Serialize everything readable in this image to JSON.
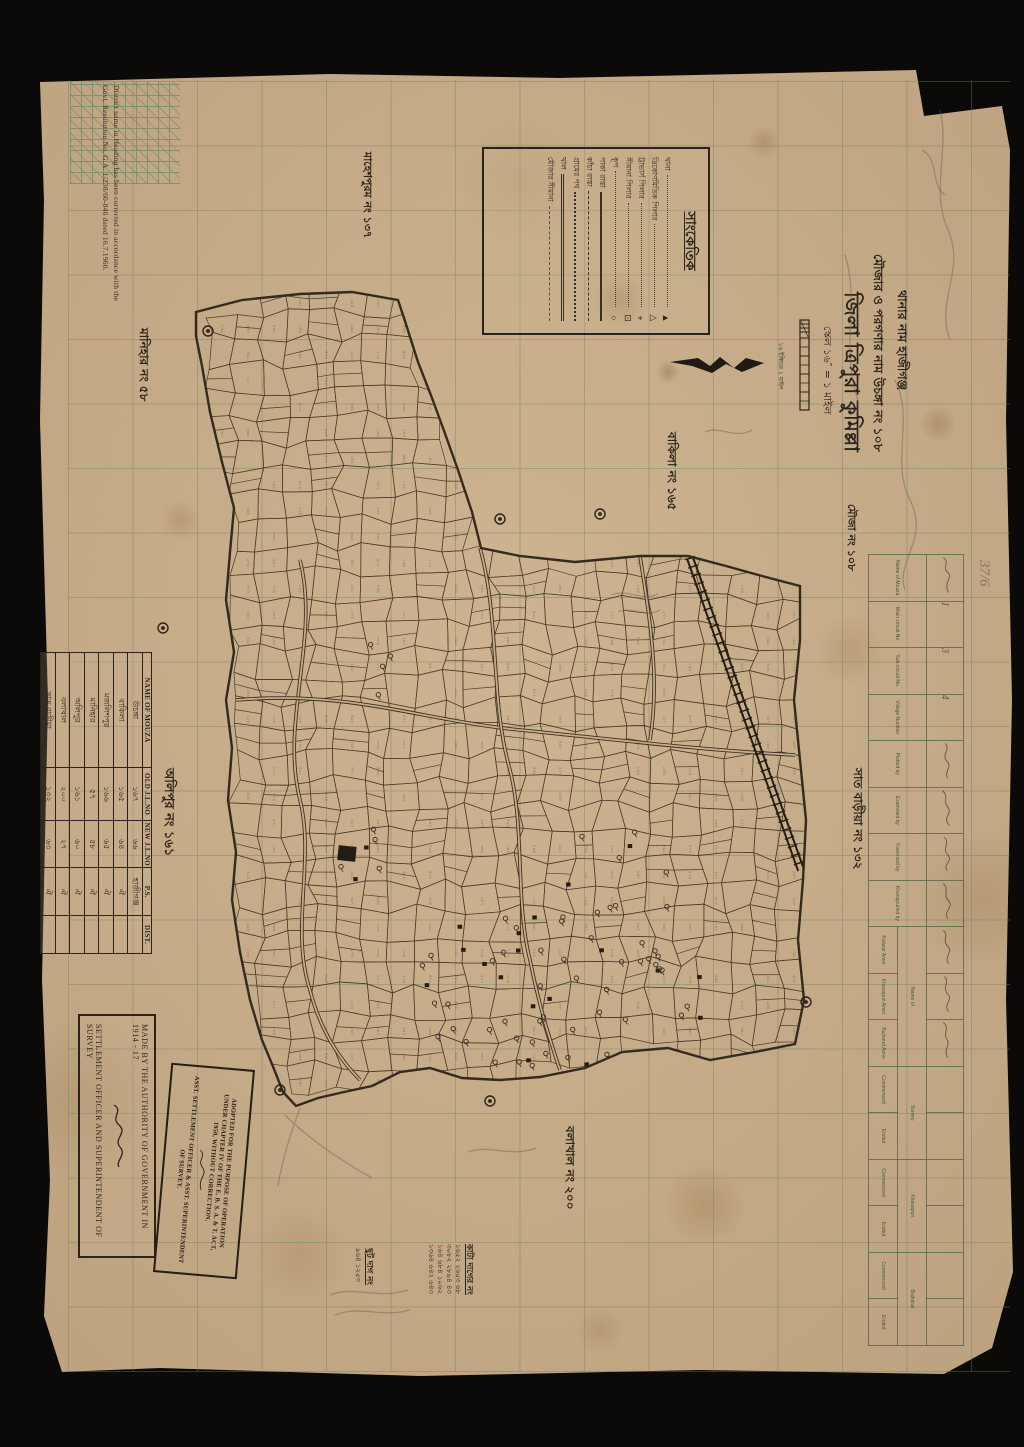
{
  "colors": {
    "background": "#0b0a08",
    "paper": "#c8ad89",
    "ink": "#2c241c",
    "grid_green": "#648462"
  },
  "corner_note": {
    "line1": "District name in Heading has been corrected in accordance with the",
    "line2": "Govt. Resolution No. G.A. 1/238/60-846 dated 16.7.1960."
  },
  "title_block": {
    "thana_line": "থানার নাম হাজীগঞ্জ",
    "mouza_line": "মৌজার ও পরগণার নাম উচঙ্গা নং ১০৮",
    "district_line": "জিলা ত্রিপুরা কুমিল্লা",
    "scale_line": "স্কেল ১৬″ = ১ মাইল",
    "sheet_line": "মৌজা নং ১০৮"
  },
  "legend": {
    "title": "সাংকেতিক",
    "symbol_items": [
      {
        "label": "থানা",
        "symbol": "▲"
      },
      {
        "label": "ত্রিকোণমিতিক পিলার",
        "symbol": "△"
      },
      {
        "label": "ট্রাভার্স পিলার",
        "symbol": "+"
      },
      {
        "label": "সীমানা পিলার",
        "symbol": "⊡"
      },
      {
        "label": "কূপ",
        "symbol": "○"
      }
    ],
    "line_items": [
      {
        "label": "পাকা রাস্তা",
        "style": "solid"
      },
      {
        "label": "কাঁচা রাস্তা",
        "style": "dashed"
      },
      {
        "label": "গ্রামের পথ",
        "style": "dotted"
      },
      {
        "label": "খাল",
        "style": "double"
      },
      {
        "label": "মৌজার সীমানা",
        "style": "dashdot"
      }
    ]
  },
  "scale_bar": {
    "caption": "১৬ ইঞ্চিতে ১ মাইল"
  },
  "neighbor_labels": {
    "north": "মাহেশপুরম নং ১৩৭",
    "west_upper": "মানিহার নং ৫৮",
    "east_upper": "বাকিলা নং ১৬৫",
    "east_lower": "সাত বাড়ীয়া নং ১৩২",
    "west_lower": "অলিপুর নং ১৬১",
    "south": "বলাখাল নং ২০০"
  },
  "mouza_table": {
    "headers": [
      "NAME OF MOUZA",
      "OLD J.L.NO",
      "NEW J.L.NO",
      "P.S.",
      "DIST."
    ],
    "rows": [
      {
        "name": "উচঙ্গা",
        "old": "১৬৭",
        "new": "৬৬",
        "ps": "হাজীগঞ্জ",
        "dist": ""
      },
      {
        "name": "বাকিলা",
        "old": "১৬৫",
        "new": "৬৪",
        "ps": "ঐ",
        "dist": ""
      },
      {
        "name": "মজলিশপুর",
        "old": "১৬৬",
        "new": "৬৫",
        "ps": "ঐ",
        "dist": ""
      },
      {
        "name": "মানিহার",
        "old": "৫৭",
        "new": "৫৮",
        "ps": "ঐ",
        "dist": ""
      },
      {
        "name": "অলিপুর",
        "old": "১৬১",
        "new": "৬০",
        "ps": "ঐ",
        "dist": ""
      },
      {
        "name": "বলাখাল",
        "old": "২০০",
        "new": "২৭",
        "ps": "ঐ",
        "dist": ""
      },
      {
        "name": "সাত বাড়ীয়া",
        "old": "১৩২",
        "new": "৬৩",
        "ps": "ঐ",
        "dist": ""
      }
    ]
  },
  "authority_box": {
    "line1": "MADE BY THE AUTHORITY OF GOVERNMENT IN 1914 - 17",
    "line2": "SETTLEMENT OFFICER AND SUPERINTENDENT OF SURVEY"
  },
  "stamp": {
    "line1": "ADOPTED FOR THE PURPOSE OF OPERATION",
    "line2": "UNDER CHAPTER IV OF THE E. B. S. A. & T. ACT,",
    "line3": "1950, WITHOUT CORRECTION.",
    "line4": "ASST. SETTLEMENT OFFICER & ASST. SUPERINTENDENT",
    "line5": "OF SURVEY."
  },
  "ops_form": {
    "headers": [
      "Name of Mouza",
      "Main circuit No.",
      "Sub-circuit No.",
      "Village Number",
      "Plotted by",
      "Examined by",
      "Traversed by",
      "Khanapuried by"
    ],
    "group_name_of": "Name of",
    "sub_headers": [
      "Kistwar Amin",
      "Khanapuri Amin",
      "Bujharat Amin"
    ],
    "group_survey": "Survey",
    "group_khanapuri": "Khanapuri",
    "group_bujharat": "Bujharat",
    "date_headers": [
      "Commenced",
      "Ended"
    ],
    "entries": [
      "",
      "1",
      "3",
      "4"
    ]
  },
  "cut_plots": {
    "list1_title": "ছুট দাগ নং",
    "list1_rows": "৯৬৪  ১২৫৩",
    "list2_title": "কাটা দাগের নং",
    "list2_row1": "১৬৫২ ২৬৫৩ ৬৮",
    "list2_row2": "৩০৮২ ২৮৯৪ ৪৩",
    "list2_row3": "১৬৪ ৬৮৪ ১০৬২",
    "list2_row4": "১৩৬৪ ৬৪২ ৬৪৩"
  },
  "pencil_notes": {
    "note1": "37/6"
  }
}
